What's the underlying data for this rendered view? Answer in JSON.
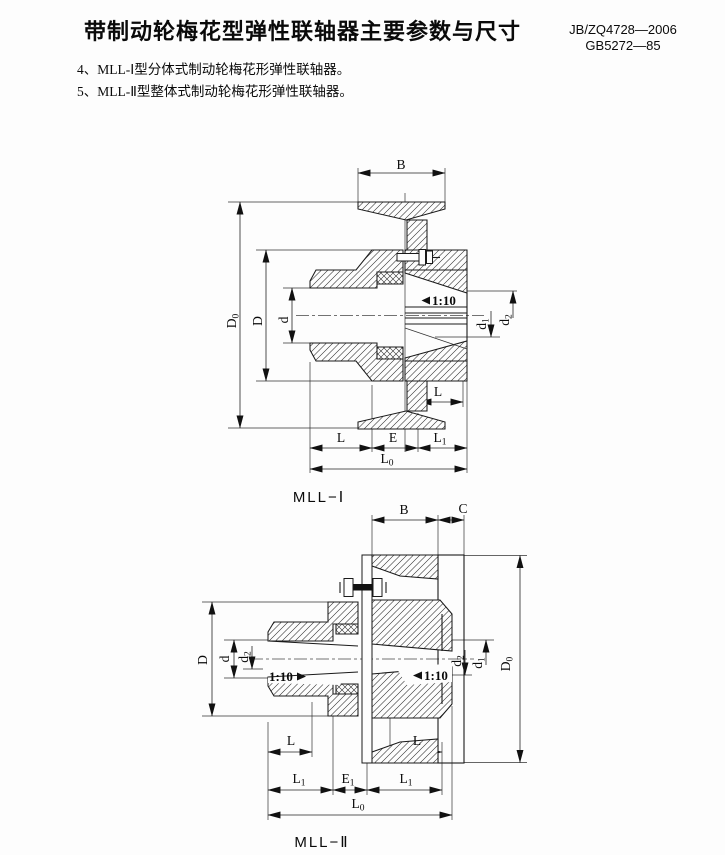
{
  "page": {
    "title": "带制动轮梅花型弹性联轴器主要参数与尺寸",
    "standards": [
      "JB/ZQ4728—2006",
      "GB5272—85"
    ],
    "notes": [
      "4、MLL-Ⅰ型分体式制动轮梅花形弹性联轴器。",
      "5、MLL-Ⅱ型整体式制动轮梅花形弹性联轴器。"
    ]
  },
  "fig1": {
    "caption": "MLL−Ⅰ",
    "taper": "1:10",
    "dims": {
      "B": {
        "base": "B"
      },
      "D0": {
        "base": "D",
        "sub": "0"
      },
      "D": {
        "base": "D"
      },
      "d": {
        "base": "d"
      },
      "d1": {
        "base": "d",
        "sub": "1"
      },
      "d2": {
        "base": "d",
        "sub": "2"
      },
      "L": {
        "base": "L"
      },
      "E": {
        "base": "E"
      },
      "L1": {
        "base": "L",
        "sub": "1"
      },
      "L0": {
        "base": "L",
        "sub": "0"
      }
    }
  },
  "fig2": {
    "caption": "MLL−Ⅱ",
    "taper": "1:10",
    "dims": {
      "B": {
        "base": "B"
      },
      "C": {
        "base": "C"
      },
      "D": {
        "base": "D"
      },
      "d": {
        "base": "d"
      },
      "d1": {
        "base": "d",
        "sub": "1"
      },
      "d2": {
        "base": "d",
        "sub": "2"
      },
      "D0": {
        "base": "D",
        "sub": "0"
      },
      "L": {
        "base": "L"
      },
      "E1": {
        "base": "E",
        "sub": "1"
      },
      "L1": {
        "base": "L",
        "sub": "1"
      },
      "L0": {
        "base": "L",
        "sub": "0"
      }
    }
  },
  "colors": {
    "ink": "#1a1a1a",
    "paper": "#fdfdfd"
  }
}
